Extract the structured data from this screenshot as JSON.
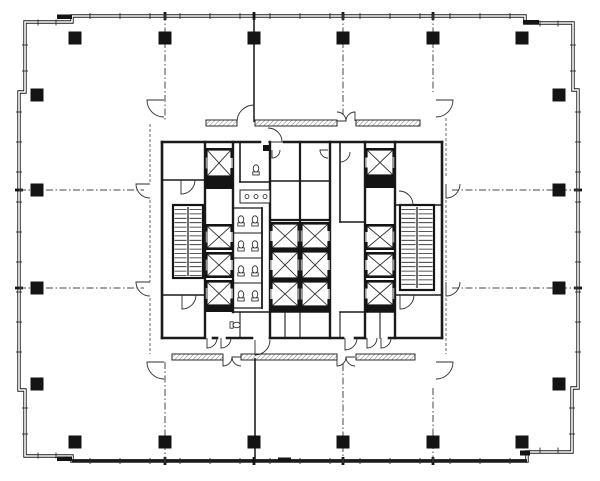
{
  "meta": {
    "drawing_type": "architectural-floor-plan",
    "subject": "high-rise office tower typical floor with central elevator core",
    "bg_color": "#ffffff",
    "ink_color": "#141414",
    "wall_color": "#1a1a1a",
    "thin_color": "#2c2c2c",
    "dash_color": "#474747",
    "boundary_dash_color": "#5a5a5a",
    "gray_color": "#9a9a9a",
    "hatch_color": "#6f6f6f"
  },
  "canvas": {
    "w": 600,
    "h": 481
  },
  "exterior": {
    "outline": "M25,22 H72 V16 H525 V23 H573 V90 H578 V388 H572 V452 H527 V461 H72 V456 H25 V390 H19 V92 H25 Z",
    "outer_stroke": 3.4,
    "inner_stroke": 1.6,
    "bottom_band": [
      72,
      459.2,
      455,
      3.0
    ],
    "heavy_marks": [
      [
        57,
        14.5,
        15,
        4.5
      ],
      [
        523,
        20,
        16,
        4.5
      ],
      [
        57,
        456.5,
        15,
        4.5
      ],
      [
        278,
        457.5,
        13,
        5
      ],
      [
        520,
        450.5,
        10,
        5
      ]
    ]
  },
  "mullion_runs": [
    {
      "o": "v",
      "pos": 16,
      "from": 90,
      "to": 510,
      "step": 30,
      "half": 3
    },
    {
      "o": "v",
      "pos": 461,
      "from": 90,
      "to": 510,
      "step": 30,
      "half": 3
    },
    {
      "o": "v",
      "pos": 22.5,
      "from": 38,
      "to": 62,
      "step": 18,
      "half": 3
    },
    {
      "o": "v",
      "pos": 455.5,
      "from": 38,
      "to": 62,
      "step": 18,
      "half": 3
    },
    {
      "o": "v",
      "pos": 23.5,
      "from": 540,
      "to": 562,
      "step": 18,
      "half": 3
    },
    {
      "o": "v",
      "pos": 450.5,
      "from": 540,
      "to": 562,
      "step": 18,
      "half": 3
    },
    {
      "o": "h",
      "pos": 19,
      "from": 112,
      "to": 368,
      "step": 30,
      "half": 3
    },
    {
      "o": "h",
      "pos": 578,
      "from": 112,
      "to": 368,
      "step": 30,
      "half": 3
    },
    {
      "o": "h",
      "pos": 25,
      "from": 45,
      "to": 80,
      "step": 26,
      "half": 3
    },
    {
      "o": "h",
      "pos": 573,
      "from": 45,
      "to": 80,
      "step": 26,
      "half": 3
    },
    {
      "o": "h",
      "pos": 25,
      "from": 408,
      "to": 442,
      "step": 26,
      "half": 3
    },
    {
      "o": "h",
      "pos": 572,
      "from": 408,
      "to": 442,
      "step": 26,
      "half": 3
    }
  ],
  "grid_wall_ticks": [
    [
      165,
      16,
      "v"
    ],
    [
      254,
      16,
      "v"
    ],
    [
      343,
      16,
      "v"
    ],
    [
      433,
      16,
      "v"
    ],
    [
      165,
      461,
      "v"
    ],
    [
      254,
      461,
      "v"
    ],
    [
      343,
      461,
      "v"
    ],
    [
      433,
      461,
      "v"
    ],
    [
      19,
      190,
      "h"
    ],
    [
      19,
      288,
      "h"
    ],
    [
      578,
      190,
      "h"
    ],
    [
      578,
      288,
      "h"
    ]
  ],
  "columns": {
    "size": 13,
    "centers": [
      [
        75,
        38
      ],
      [
        165,
        38
      ],
      [
        254,
        38
      ],
      [
        343,
        38
      ],
      [
        433,
        38
      ],
      [
        522,
        38
      ],
      [
        75,
        442
      ],
      [
        165,
        442
      ],
      [
        254,
        442
      ],
      [
        343,
        442
      ],
      [
        433,
        442
      ],
      [
        522,
        442
      ],
      [
        37,
        95
      ],
      [
        37,
        190
      ],
      [
        37,
        288
      ],
      [
        37,
        384
      ],
      [
        559,
        95
      ],
      [
        559,
        190
      ],
      [
        559,
        288
      ],
      [
        559,
        384
      ]
    ]
  },
  "grid_dash_lines": [
    [
      165,
      14,
      165,
      120
    ],
    [
      165,
      362,
      165,
      463
    ],
    [
      343,
      14,
      343,
      114
    ],
    [
      343,
      364,
      343,
      463
    ],
    [
      433,
      14,
      433,
      92
    ],
    [
      433,
      388,
      433,
      463
    ],
    [
      19,
      190,
      144,
      190
    ],
    [
      452,
      190,
      580,
      190
    ],
    [
      19,
      288,
      144,
      288
    ],
    [
      452,
      288,
      580,
      288
    ]
  ],
  "solid_partitions": [
    [
      254,
      18,
      254,
      122
    ],
    [
      255,
      358,
      255,
      460
    ]
  ],
  "core_boundary_dash": [
    [
      150,
      124,
      150,
      183
    ],
    [
      150,
      200,
      150,
      282
    ],
    [
      150,
      298,
      150,
      354
    ],
    [
      446,
      118,
      446,
      178
    ],
    [
      446,
      200,
      446,
      281
    ],
    [
      446,
      298,
      446,
      354
    ]
  ],
  "hatch_walls": [
    [
      206,
      120,
      31,
      6
    ],
    [
      255,
      120,
      82,
      6
    ],
    [
      356,
      120,
      64,
      6
    ],
    [
      172,
      354,
      51,
      6
    ],
    [
      241,
      354,
      96,
      6
    ],
    [
      356,
      354,
      59,
      6
    ]
  ],
  "core_walls": [
    [
      162,
      142,
      260,
      142,
      2.6
    ],
    [
      284,
      142,
      442,
      142,
      2.6
    ],
    [
      162,
      142,
      162,
      338,
      2.6
    ],
    [
      442,
      142,
      442,
      338,
      2.6
    ],
    [
      162,
      338,
      203,
      338,
      2.6
    ],
    [
      213,
      338,
      217,
      338,
      2.6
    ],
    [
      227,
      338,
      252,
      338,
      2.6
    ],
    [
      270,
      338,
      343,
      338,
      2.6
    ],
    [
      355,
      338,
      365,
      338,
      2.6
    ],
    [
      389,
      338,
      442,
      338,
      2.6
    ],
    [
      162,
      180,
      205,
      180,
      1.6
    ],
    [
      162,
      295,
      205,
      295,
      1.6
    ],
    [
      205,
      142,
      205,
      338,
      2.4
    ],
    [
      233,
      142,
      233,
      312,
      2.4
    ],
    [
      240,
      142,
      240,
      182,
      1.6
    ],
    [
      240,
      182,
      270,
      182,
      1.6
    ],
    [
      262,
      208,
      262,
      308,
      1.8
    ],
    [
      234,
      208,
      262,
      208,
      1.3
    ],
    [
      234,
      308,
      262,
      308,
      1.3
    ],
    [
      234,
      233,
      262,
      233,
      0.9
    ],
    [
      234,
      258,
      262,
      258,
      0.9
    ],
    [
      234,
      283,
      262,
      283,
      0.9
    ],
    [
      233,
      312,
      270,
      312,
      1.6
    ],
    [
      240,
      312,
      240,
      338,
      1.1
    ],
    [
      270,
      142,
      270,
      338,
      2.4
    ],
    [
      300,
      142,
      300,
      308,
      2.2
    ],
    [
      330,
      142,
      330,
      338,
      2.4
    ],
    [
      270,
      181,
      330,
      181,
      1.6
    ],
    [
      270,
      220,
      330,
      220,
      2.2
    ],
    [
      270,
      312,
      330,
      312,
      1.6
    ],
    [
      285,
      312,
      285,
      338,
      1.1
    ],
    [
      300,
      312,
      300,
      338,
      1.1
    ],
    [
      340,
      142,
      340,
      222,
      1.6
    ],
    [
      340,
      222,
      365,
      222,
      1.6
    ],
    [
      340,
      312,
      365,
      312,
      1.6
    ],
    [
      340,
      312,
      340,
      338,
      1.1
    ],
    [
      365,
      142,
      365,
      338,
      2.4
    ],
    [
      395,
      142,
      395,
      338,
      2.4
    ],
    [
      365,
      312,
      395,
      312,
      1.6
    ],
    [
      380,
      312,
      380,
      338,
      1.1
    ],
    [
      395,
      205,
      442,
      205,
      1.6
    ],
    [
      395,
      295,
      442,
      295,
      1.6
    ],
    [
      434,
      205,
      434,
      290,
      1.8
    ]
  ],
  "core_black_rects": [
    [
      205,
      178,
      28,
      11
    ],
    [
      365,
      177,
      30,
      11
    ],
    [
      205,
      307,
      28,
      5
    ],
    [
      365,
      307,
      30,
      5
    ],
    [
      270,
      308,
      60,
      4
    ],
    [
      263,
      145,
      6,
      6
    ]
  ],
  "elevators": [
    [
      205,
      148,
      28,
      30,
      "R"
    ],
    [
      205,
      224,
      28,
      26,
      "R"
    ],
    [
      205,
      252,
      28,
      26,
      "R"
    ],
    [
      205,
      280,
      28,
      27,
      "R"
    ],
    [
      270,
      222,
      30,
      28,
      "L"
    ],
    [
      270,
      250,
      30,
      30,
      "L"
    ],
    [
      270,
      280,
      30,
      28,
      "L"
    ],
    [
      300,
      222,
      30,
      28,
      "R"
    ],
    [
      300,
      250,
      30,
      30,
      "R"
    ],
    [
      300,
      280,
      30,
      28,
      "R"
    ],
    [
      365,
      148,
      30,
      29,
      "L"
    ],
    [
      365,
      224,
      30,
      26,
      "L"
    ],
    [
      365,
      252,
      30,
      26,
      "L"
    ],
    [
      365,
      280,
      30,
      27,
      "L"
    ]
  ],
  "stairs": [
    [
      173,
      205,
      30,
      73
    ],
    [
      400,
      205,
      34,
      85
    ]
  ],
  "toilets": [
    [
      241,
      221,
      0
    ],
    [
      255,
      221,
      0
    ],
    [
      241,
      246,
      0
    ],
    [
      255,
      246,
      0
    ],
    [
      241,
      271,
      0
    ],
    [
      255,
      271,
      0
    ],
    [
      241,
      296,
      0
    ],
    [
      255,
      296,
      0
    ],
    [
      256,
      170,
      0
    ],
    [
      235,
      325,
      90
    ]
  ],
  "sink_counter": {
    "rect": [
      240,
      190,
      30,
      13
    ],
    "holes_cx": [
      247,
      256,
      265
    ],
    "holes_cy": 196.5,
    "hole_r": 2
  },
  "door_arcs": [
    [
      164,
      100,
      17,
      180,
      270
    ],
    [
      436,
      100,
      17,
      360,
      270
    ],
    [
      164,
      362,
      17,
      180,
      270
    ],
    [
      436,
      362,
      17,
      360,
      270
    ],
    [
      254,
      122,
      17,
      90,
      180
    ],
    [
      268,
      142,
      14,
      0,
      90
    ],
    [
      337,
      121,
      9,
      0,
      90
    ],
    [
      355,
      121,
      9,
      90,
      180
    ],
    [
      337,
      357,
      9,
      270,
      360
    ],
    [
      355,
      357,
      9,
      180,
      270
    ],
    [
      223,
      357,
      9,
      270,
      360
    ],
    [
      241,
      357,
      9,
      180,
      270
    ],
    [
      255,
      340,
      15,
      270,
      360
    ],
    [
      150,
      184,
      14,
      180,
      270
    ],
    [
      150,
      282,
      14,
      180,
      270
    ],
    [
      446,
      184,
      14,
      270,
      360
    ],
    [
      446,
      282,
      14,
      270,
      360
    ],
    [
      181,
      180,
      14,
      270,
      360
    ],
    [
      182,
      295,
      14,
      270,
      360
    ],
    [
      399,
      205,
      14,
      0,
      90
    ],
    [
      400,
      295,
      14,
      270,
      360
    ],
    [
      272,
      150,
      8,
      270,
      360
    ],
    [
      328,
      150,
      8,
      180,
      270
    ],
    [
      340,
      152,
      10,
      270,
      360
    ],
    [
      345,
      338,
      12,
      270,
      360
    ],
    [
      207,
      338,
      10,
      270,
      360
    ],
    [
      221,
      338,
      10,
      270,
      360
    ],
    [
      367,
      338,
      10,
      270,
      360
    ],
    [
      381,
      338,
      10,
      270,
      360
    ]
  ],
  "features": [
    "perimeter-curtain-wall",
    "structural-columns",
    "column-grid-lines",
    "elevator-shafts",
    "egress-stairs",
    "restroom-core",
    "door-swings",
    "demising-partitions",
    "core-corridor"
  ]
}
